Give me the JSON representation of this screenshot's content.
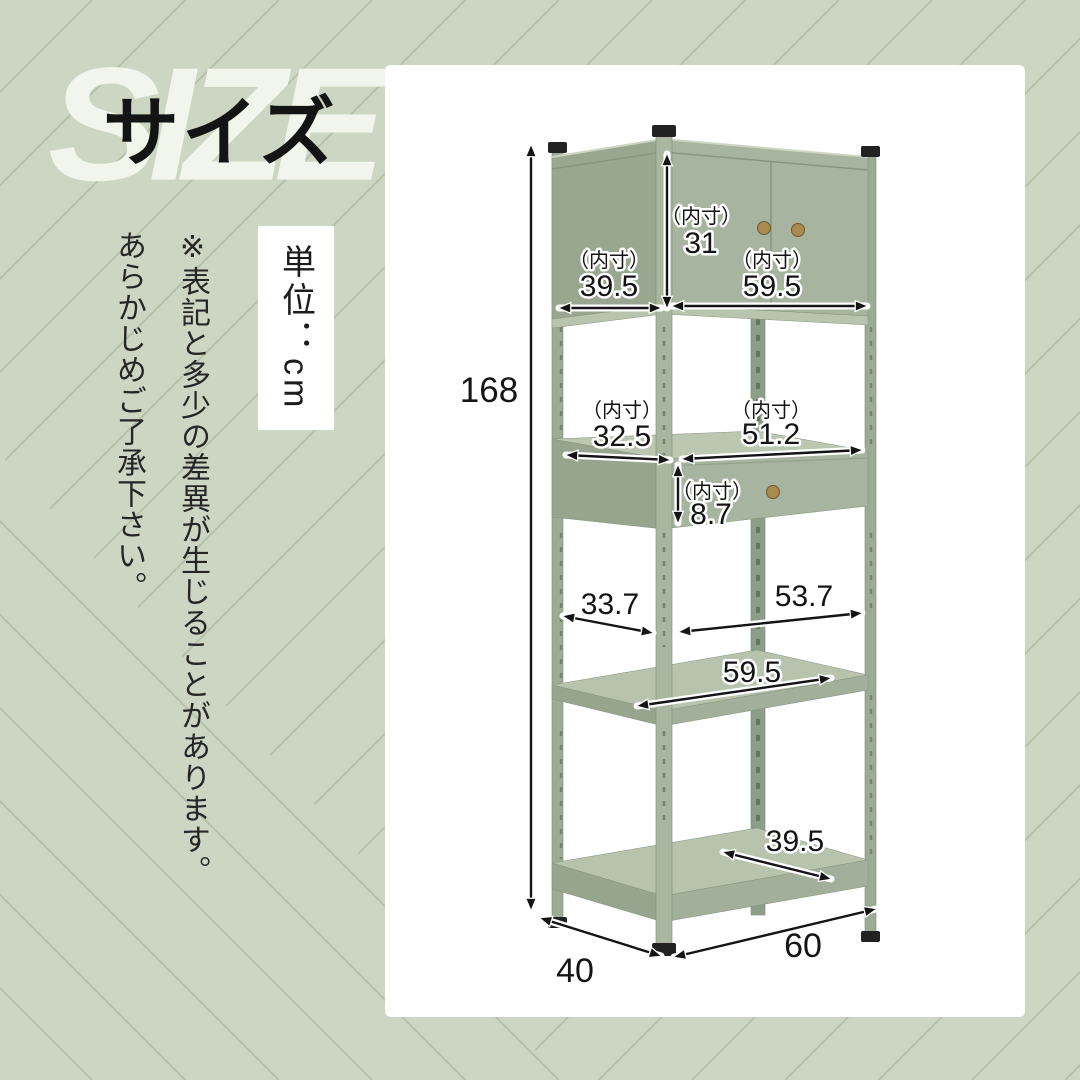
{
  "header": {
    "size_en": "SIZE",
    "size_ja": "サイズ",
    "unit": "単位：cm"
  },
  "notes": [
    "※表記と多少の差異が生じることがあります。",
    "あらかじめご了承下さい。"
  ],
  "colors": {
    "background": "#cdd6c3",
    "pattern_line": "#b7c2ac",
    "card": "#ffffff",
    "shelf_front": "#a7b4a0",
    "shelf_side": "#97a58f",
    "shelf_top": "#b7c3ac",
    "post": "#9dab95",
    "cap": "#222222",
    "knob_brass": "#ab8a4d",
    "dimension_text": "#141414"
  },
  "diagram": {
    "unit": "cm",
    "inner_label": "（内寸）",
    "total_height": "168",
    "top_cabinet": {
      "inner_width_left": "39.5",
      "inner_height": "31",
      "inner_width_right": "59.5"
    },
    "middle": {
      "inner_width_left": "32.5",
      "inner_width_right": "51.2",
      "drawer_inner_height": "8.7"
    },
    "open_shelf": {
      "left_width": "33.7",
      "right_width": "53.7",
      "shelf_width": "59.5"
    },
    "bottom": {
      "shelf_width": "39.5",
      "depth": "40",
      "width": "60"
    }
  }
}
